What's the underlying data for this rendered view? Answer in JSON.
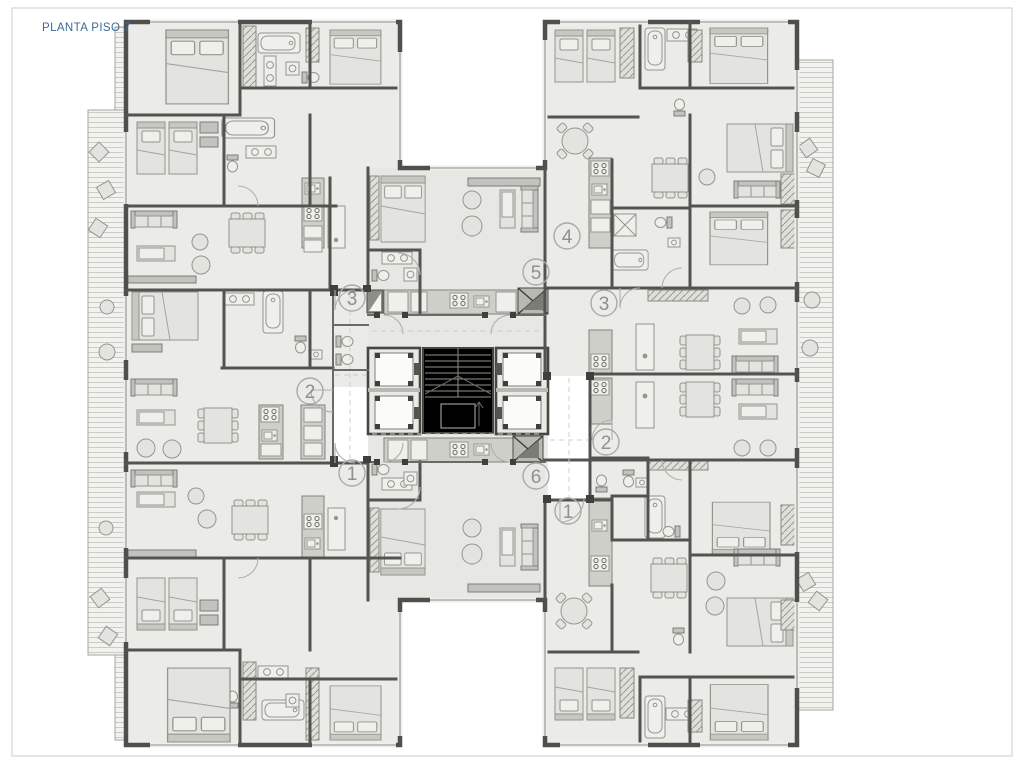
{
  "title": "PLANTA PISO 7",
  "units": [
    {
      "id": "left-3",
      "label": "3"
    },
    {
      "id": "left-2",
      "label": "2"
    },
    {
      "id": "left-1",
      "label": "1"
    },
    {
      "id": "center-4",
      "label": "4"
    },
    {
      "id": "center-5",
      "label": "5"
    },
    {
      "id": "center-6",
      "label": "6"
    },
    {
      "id": "right-3",
      "label": "3"
    },
    {
      "id": "right-2",
      "label": "2"
    },
    {
      "id": "right-1",
      "label": "1"
    }
  ],
  "colors": {
    "accent_title": "#3a6a9b",
    "wall": "#4f4f4d",
    "floor": "#ebebe7",
    "floor_core": "#e7e7e3",
    "balcony": "#f2f2ef",
    "marker": "#a9a9a5",
    "furniture": "#e3e3df"
  }
}
